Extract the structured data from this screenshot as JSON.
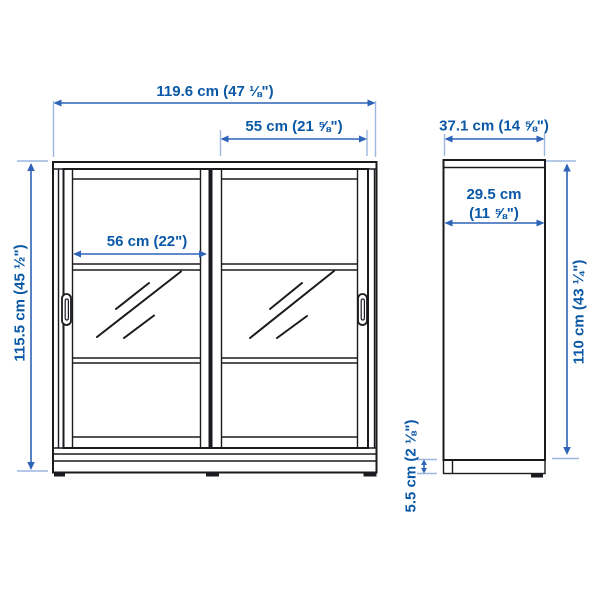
{
  "colors": {
    "background": "#ffffff",
    "outline": "#1b1b1f",
    "dimension_text": "#0a58a6",
    "dimension_line": "#2e63b7",
    "extension_line": "#9cb6e0"
  },
  "measurements": {
    "total_width": {
      "cm": 119.6,
      "label": "119.6 cm (47 ⅛\")"
    },
    "door_width": {
      "cm": 55,
      "label": "55 cm (21 ⅝\")"
    },
    "inner_width": {
      "cm": 56,
      "label": "56 cm (22\")"
    },
    "total_height": {
      "cm": 115.5,
      "label": "115.5 cm (45 ½\")"
    },
    "total_depth": {
      "cm": 37.1,
      "label": "37.1 cm (14 ⅝\")"
    },
    "body_depth": {
      "cm": 29.5,
      "label_line1": "29.5 cm",
      "label_line2": "(11 ⅝\")"
    },
    "body_height": {
      "cm": 110,
      "label": "110 cm (43 ¼\")"
    },
    "plinth_height": {
      "cm": 5.5,
      "label": "5.5 cm (2 ⅛\")"
    }
  }
}
